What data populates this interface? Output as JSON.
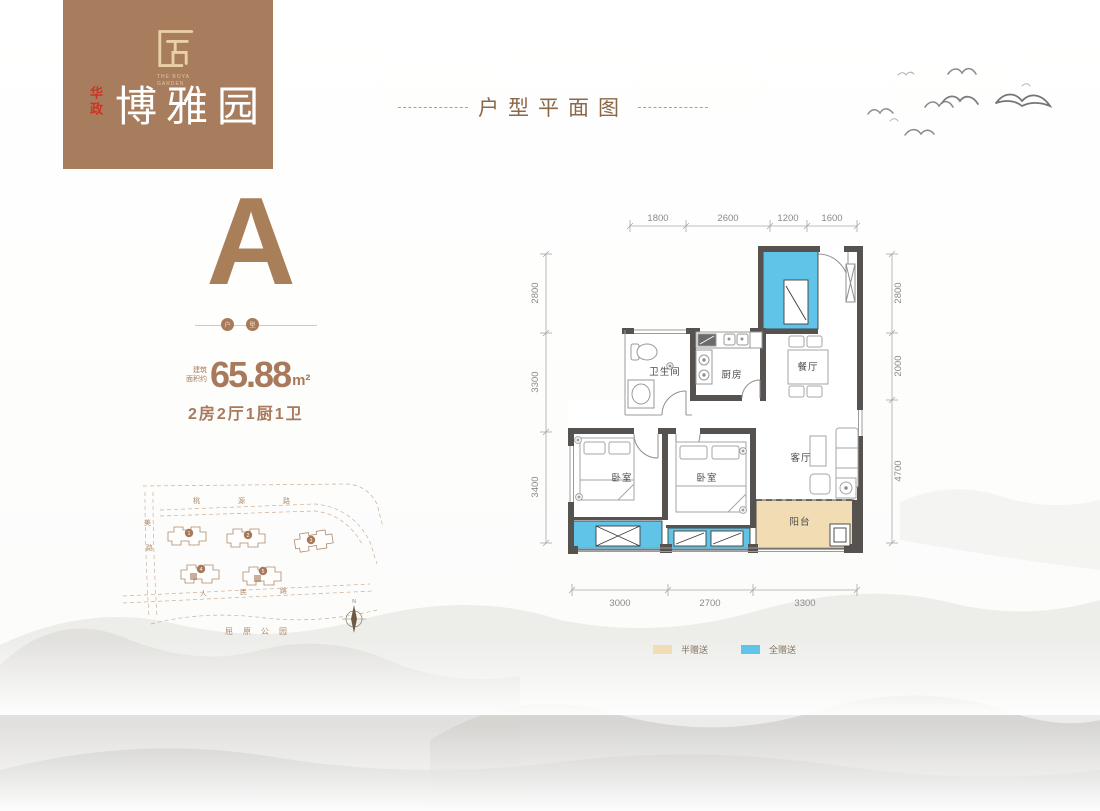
{
  "logo": {
    "seal_char": "匠",
    "en_line1": "THE BOYA",
    "en_line2": "GARDEN",
    "brand_vertical": "华政",
    "name": "博雅园"
  },
  "header": {
    "title": "户型平面图"
  },
  "unit": {
    "type_letter": "A",
    "divider_circle1": "户",
    "divider_circle2": "型",
    "area_prefix_line1": "建筑",
    "area_prefix_line2": "面积约",
    "area_value": "65.88",
    "area_unit": "m²",
    "layout_desc": "2房2厅1厨1卫"
  },
  "plan": {
    "labels": {
      "bathroom": "卫生间",
      "kitchen": "厨房",
      "dining": "餐厅",
      "living": "客厅",
      "bedroom_left": "卧室",
      "bedroom_mid": "卧室",
      "balcony": "阳台"
    },
    "dims": {
      "top": [
        "1800",
        "2600",
        "1200",
        "1600"
      ],
      "left": [
        "2800",
        "3300",
        "3400"
      ],
      "right": [
        "2800",
        "2000",
        "4700"
      ],
      "bottom": [
        "3000",
        "2700",
        "3300"
      ]
    }
  },
  "legend": {
    "half_gift": "半赠送",
    "full_gift": "全赠送"
  },
  "sitemap": {
    "road_top": "桃源路",
    "road_left_char1": "美",
    "road_left_char2": "路",
    "road_bottom": "人民路",
    "park": "屈原公园",
    "buildings": [
      "1",
      "2",
      "3",
      "4",
      "5"
    ],
    "compass_n": "N"
  },
  "colors": {
    "brand_brown": "#a87d5e",
    "accent_brown": "#a8795a",
    "brand_red": "#cf3222",
    "full_gift_blue": "#5fc4e7",
    "half_gift_tan": "#f2dcb4",
    "wall_gray": "#565250"
  }
}
